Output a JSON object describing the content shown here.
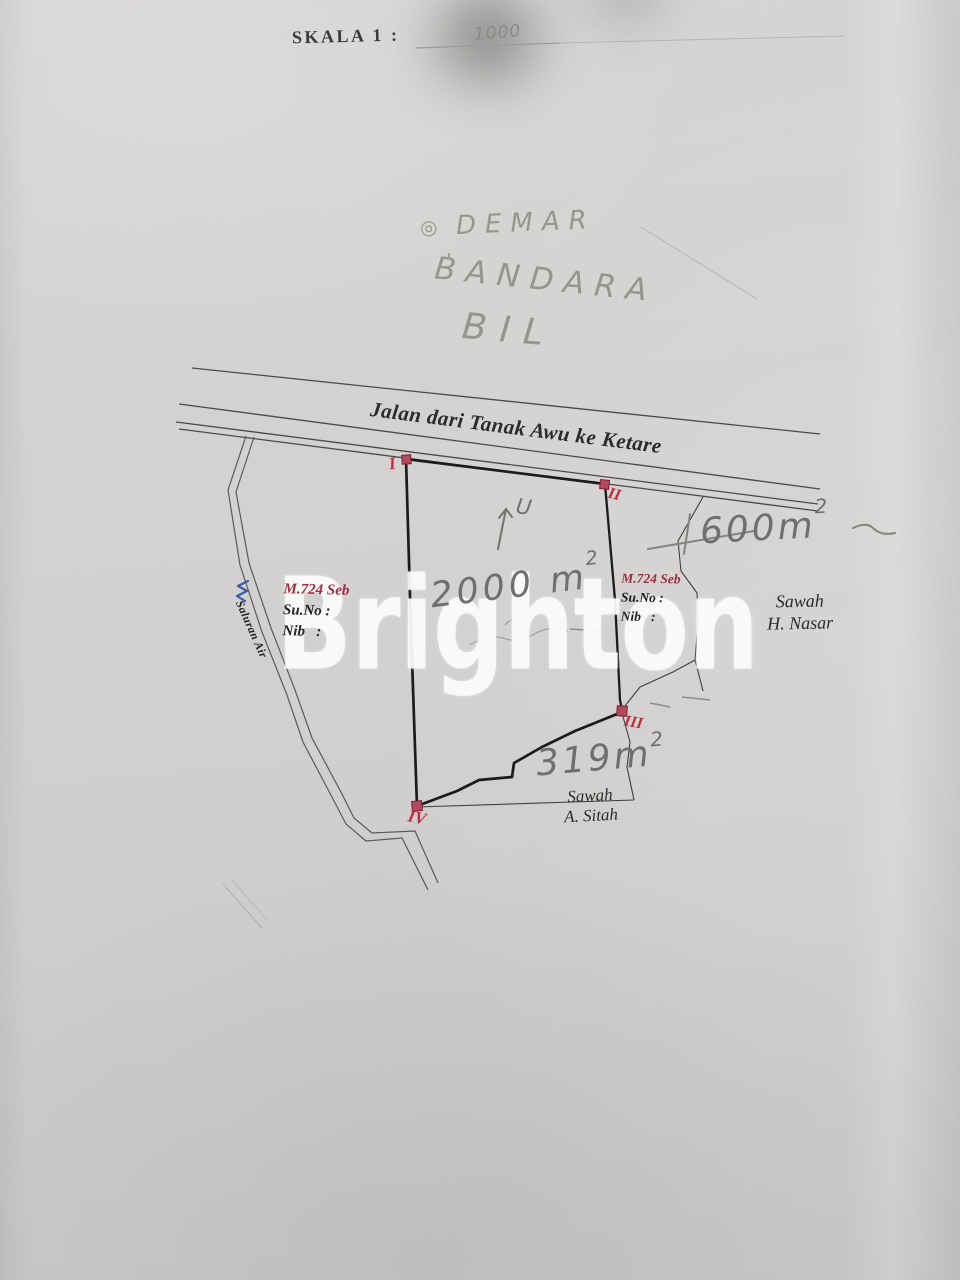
{
  "document": {
    "scale": {
      "label": "SKALA 1 :",
      "value": "1000"
    },
    "handwritten_notes": {
      "marker": "◎",
      "line1": "DEMAR",
      "accent": "'",
      "line2": "BANDARA",
      "line3": "BIL"
    },
    "north_arrow_label": "U",
    "road": {
      "label": "Jalan dari Tanak Awu ke Ketare"
    },
    "canal": {
      "label": "Saluran Air"
    },
    "parcel_left": {
      "code": "M.724 Seb",
      "row1": "Su.No :",
      "row2": "Nib   :"
    },
    "parcel_right": {
      "code": "M.724 Seb",
      "row1": "Su.No :",
      "row2": "Nib   :"
    },
    "neighbor_east": {
      "line1": "Sawah",
      "line2": "H. Nasar"
    },
    "neighbor_south": {
      "line1": "Sawah",
      "line2": "A. Sitah"
    },
    "areas": {
      "main": {
        "value": "2000 m",
        "sup": "2"
      },
      "east": {
        "prefix": "+",
        "value": "600m",
        "sup": "2"
      },
      "south": {
        "value": "319m",
        "sup": "2"
      }
    },
    "boundary_markers": {
      "p1": "I",
      "p2": "II",
      "p3": "III",
      "p4": "IV"
    }
  },
  "watermark": {
    "text": "Brighton"
  },
  "colors": {
    "paper": "#d3d2d0",
    "ink": "#2b2b29",
    "red_label": "#a32c3f",
    "marker_red": "#b4485c",
    "numeral_red": "#c22a3e",
    "pencil": "#6f6f6d",
    "canal_blue": "#3b57a8"
  }
}
